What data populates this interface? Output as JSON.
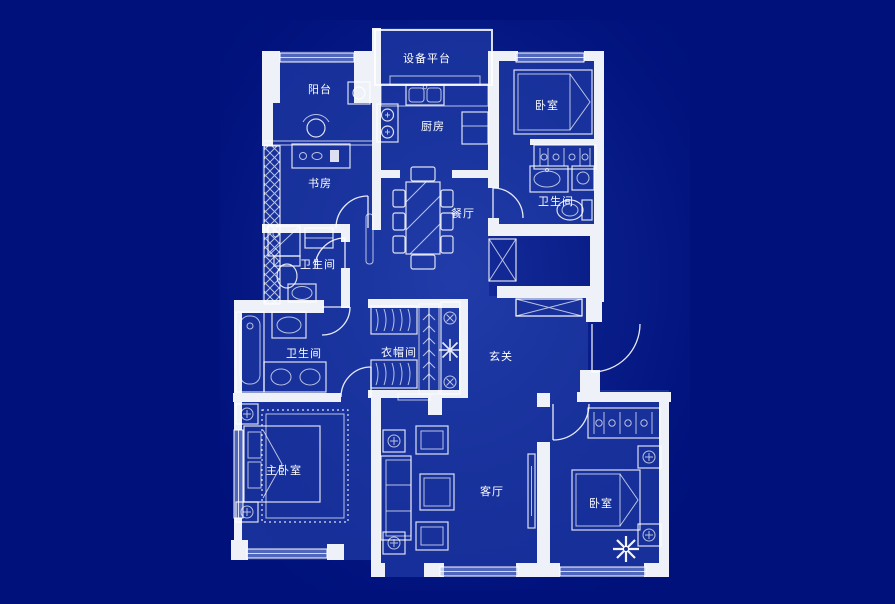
{
  "title": "apartment-floor-plan-blueprint",
  "colors": {
    "background": "#00117c",
    "plan_fill": "#17309a",
    "wall": "#eef1f8",
    "line": "#ffffff"
  },
  "rooms": [
    {
      "id": "equipment-platform",
      "label": "设备平台"
    },
    {
      "id": "balcony",
      "label": "阳台"
    },
    {
      "id": "bedroom-top-right",
      "label": "卧室"
    },
    {
      "id": "kitchen",
      "label": "厨房"
    },
    {
      "id": "study",
      "label": "书房"
    },
    {
      "id": "bathroom-suite",
      "label": "卫生间"
    },
    {
      "id": "dining-room",
      "label": "餐厅"
    },
    {
      "id": "bathroom-upper",
      "label": "卫生间"
    },
    {
      "id": "bathroom-lower",
      "label": "卫生间"
    },
    {
      "id": "cloakroom",
      "label": "衣帽间"
    },
    {
      "id": "entrance-hall",
      "label": "玄关"
    },
    {
      "id": "master-bedroom",
      "label": "主卧室"
    },
    {
      "id": "living-room",
      "label": "客厅"
    },
    {
      "id": "bedroom-bottom-right",
      "label": "卧室"
    }
  ],
  "icons": {
    "lamp": "circle-cross-lamp-icon",
    "vent": "circle-x-vent-icon",
    "plant": "plant-star-icon"
  }
}
